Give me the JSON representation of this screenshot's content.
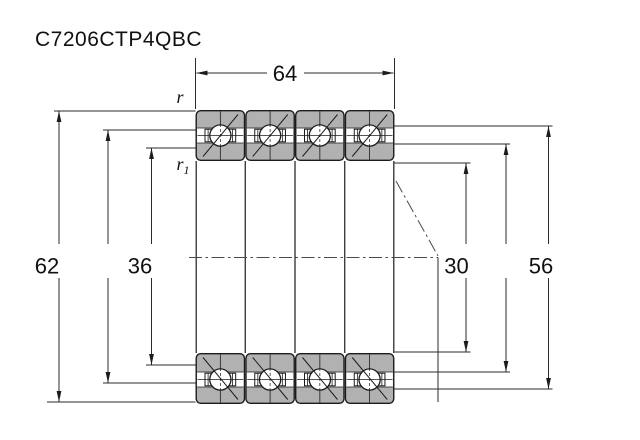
{
  "title": "C7206CTP4QBC",
  "dimensions": {
    "width_top": "64",
    "outer_diameter_left": "62",
    "shoulder_left": "36",
    "bore_right": "30",
    "shoulder_right": "56"
  },
  "radius_labels": {
    "r": "r",
    "r1_base": "r",
    "r1_sub": "1"
  },
  "colors": {
    "ring_fill": "#b1b1b1",
    "outline": "#1c1c1c",
    "dimension_line": "#2b2b2b",
    "background": "#ffffff"
  }
}
